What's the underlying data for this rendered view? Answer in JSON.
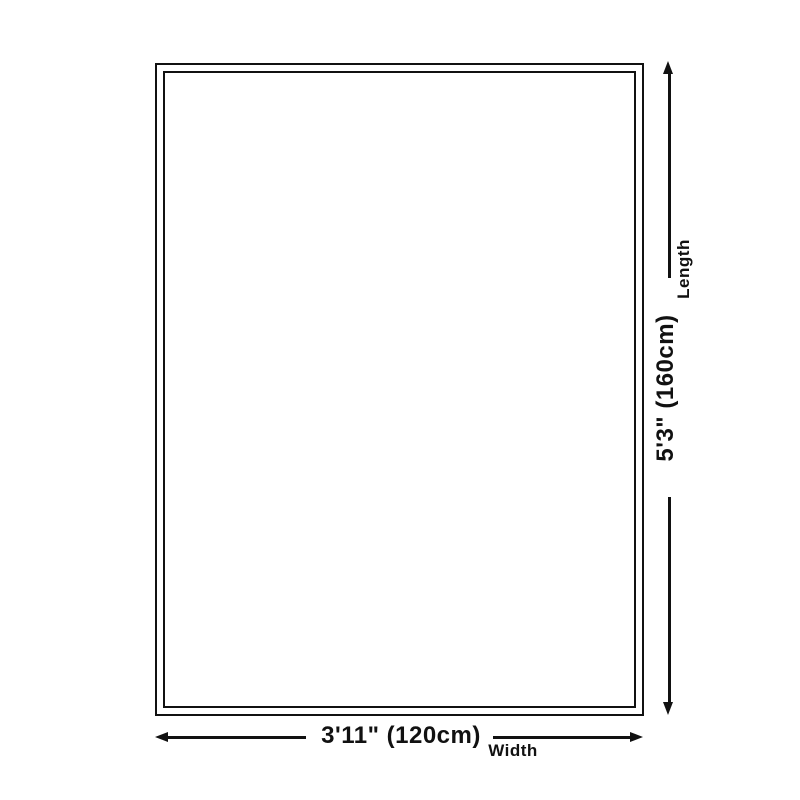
{
  "page": {
    "background": "#ffffff"
  },
  "diagram": {
    "kind": "product-size-diagram",
    "line_color": "#111111",
    "shape": "rectangle-double-border",
    "length": {
      "value": "5'3\" (160cm)",
      "label": "Length"
    },
    "width": {
      "value": "3'11\" (120cm)",
      "label": "Width"
    }
  }
}
